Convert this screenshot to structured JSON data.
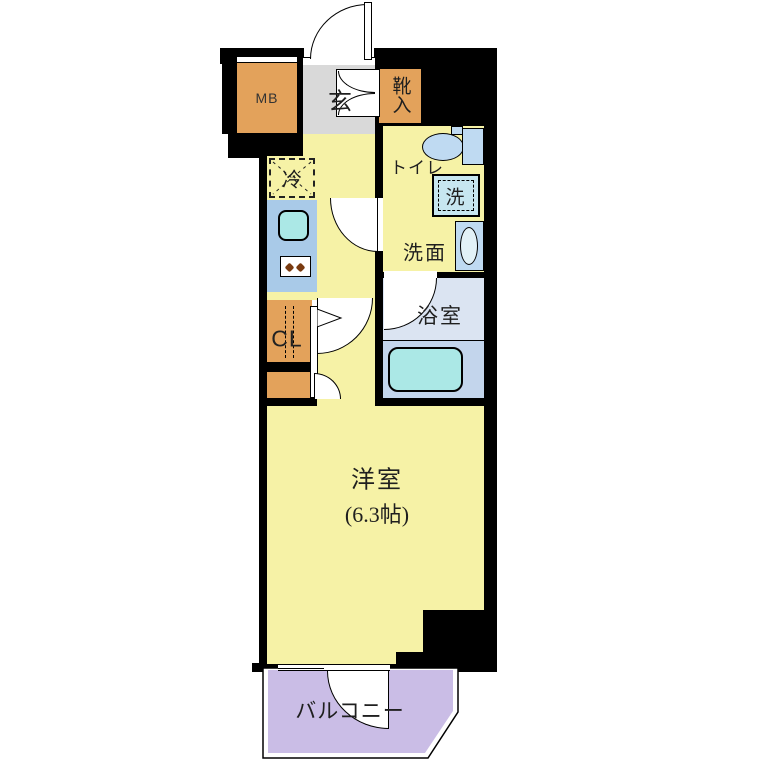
{
  "floorplan": {
    "type": "japanese-apartment-1K-floorplan",
    "labels": {
      "meter_box": "MB",
      "entrance": "玄",
      "shoe_cabinet": "靴入",
      "refrigerator": "冷",
      "toilet": "トイレ",
      "washing_machine": "洗",
      "washroom": "洗面",
      "bathroom": "浴室",
      "closet": "CL",
      "western_room": "洋室",
      "western_room_size": "(6.3帖)",
      "balcony": "バルコニー"
    },
    "colors": {
      "wall": "#000000",
      "room_yellow": "#F6F2A6",
      "entrance_gray": "#D9D9D9",
      "storage_orange": "#E3A25B",
      "kitchen_blue": "#A9CAE8",
      "fixture_cyan": "#ABE8E6",
      "fixture_blue": "#BFDAF2",
      "bath_upper": "#DBE4F2",
      "bath_lower": "#C3D5EC",
      "balcony_purple": "#CABDE6"
    }
  }
}
